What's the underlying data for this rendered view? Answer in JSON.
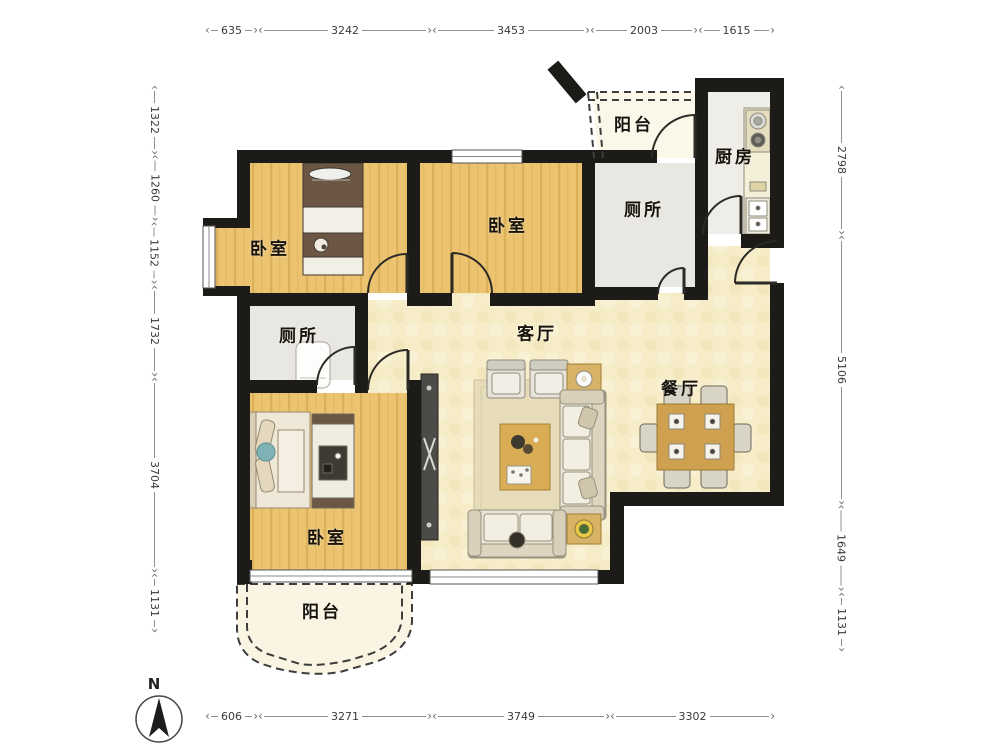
{
  "plan": {
    "rooms": [
      {
        "key": "balcony_top",
        "label": "阳台"
      },
      {
        "key": "kitchen",
        "label": "厨房"
      },
      {
        "key": "toilet_top",
        "label": "厕所"
      },
      {
        "key": "bedroom_a",
        "label": "卧室"
      },
      {
        "key": "bedroom_b",
        "label": "卧室"
      },
      {
        "key": "living_room",
        "label": "客厅"
      },
      {
        "key": "dining_room",
        "label": "餐厅"
      },
      {
        "key": "toilet_mid",
        "label": "厕所"
      },
      {
        "key": "bedroom_master",
        "label": "卧室"
      },
      {
        "key": "balcony_bottom",
        "label": "阳台"
      }
    ]
  },
  "dimensions": {
    "top": [
      "635",
      "3242",
      "3453",
      "2003",
      "1615"
    ],
    "bottom": [
      "606",
      "3271",
      "3749",
      "3302"
    ],
    "left": [
      "1322",
      "1260",
      "1152",
      "1732",
      "3704",
      "1131"
    ],
    "right": [
      "2798",
      "5106",
      "1649",
      "1131"
    ]
  },
  "compass": {
    "label": "N"
  },
  "colors": {
    "wall": "#1d1b18",
    "wood_floor": "#ecc471",
    "cream_floor": "#f6edc8",
    "tile_floor": "#e9e7e1",
    "balcony_floor": "#fbf8ea",
    "table_wood": "#d3a352",
    "sofa": "#ece6d6"
  }
}
